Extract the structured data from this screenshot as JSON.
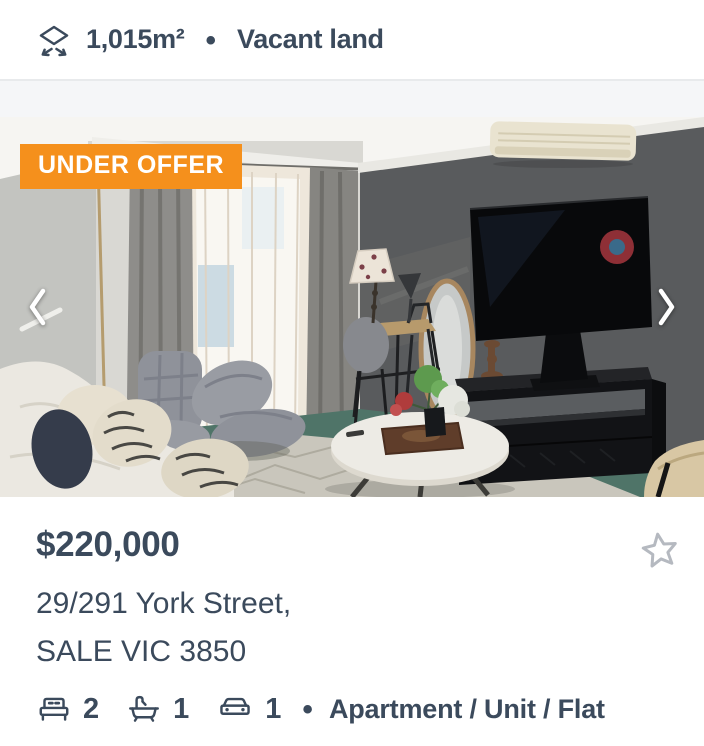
{
  "previous_listing": {
    "land_size": "1,015m²",
    "separator": "•",
    "property_type": "Vacant land",
    "land_size_icon": "land-size-icon"
  },
  "listing": {
    "status_badge": "UNDER OFFER",
    "photo": "living-room-photo",
    "price": "$220,000",
    "address_line_1": "29/291 York Street,",
    "address_line_2": "SALE VIC 3850",
    "features": [
      {
        "icon": "bed-icon",
        "value": "2"
      },
      {
        "icon": "bath-icon",
        "value": "1"
      },
      {
        "icon": "car-icon",
        "value": "1"
      }
    ],
    "separator": "•",
    "property_type": "Apartment / Unit / Flat",
    "save_icon": "star-icon"
  },
  "carousel": {
    "prev_icon": "chevron-left-icon",
    "next_icon": "chevron-right-icon"
  },
  "colors": {
    "text_primary": "#3b4a5c",
    "badge_background": "#f5901c",
    "badge_text": "#ffffff",
    "star_outline": "#b5b9c0",
    "divider": "#e8eaec",
    "card_gap_background": "#f5f6f8"
  }
}
